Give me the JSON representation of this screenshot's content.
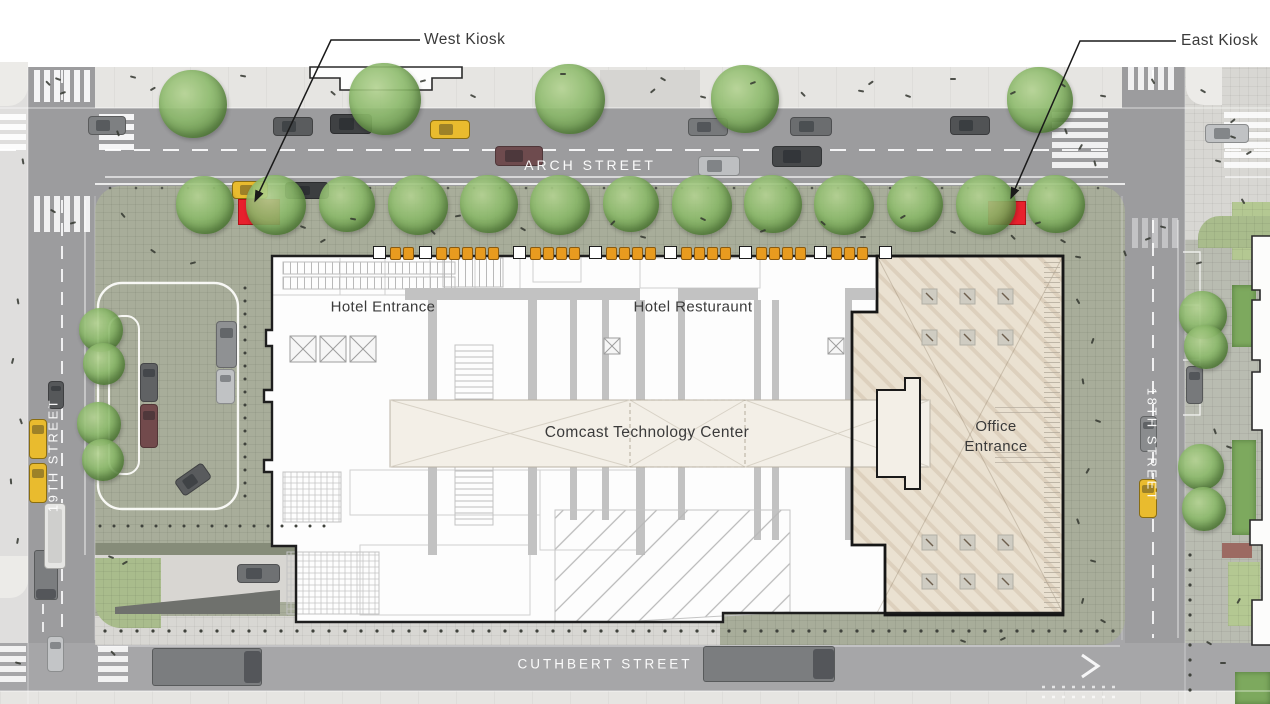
{
  "title": "Comcast Technology Center — ground level site plan",
  "legend": {
    "west_kiosk": "West Kiosk",
    "east_kiosk": "East Kiosk"
  },
  "streets": {
    "north": "ARCH STREET",
    "south": "CUTHBERT STREET",
    "west": "19TH STREET",
    "east": "18TH STREET"
  },
  "building": {
    "name": "Comcast Technology Center",
    "hotel_entrance": "Hotel Entrance",
    "hotel_restaurant": "Hotel Resturaunt",
    "office_line1": "Office",
    "office_line2": "Entrance"
  },
  "colors": {
    "kiosk_red": "#e8202d",
    "plaza_green": "#a8ad9a",
    "office_plaza_beige": "#eae1d1",
    "road_gray": "#9c9c9e",
    "taxi_yellow": "#e9bb2e",
    "tree_green": "#7fae5d",
    "building_outline": "#1e1e1e"
  }
}
